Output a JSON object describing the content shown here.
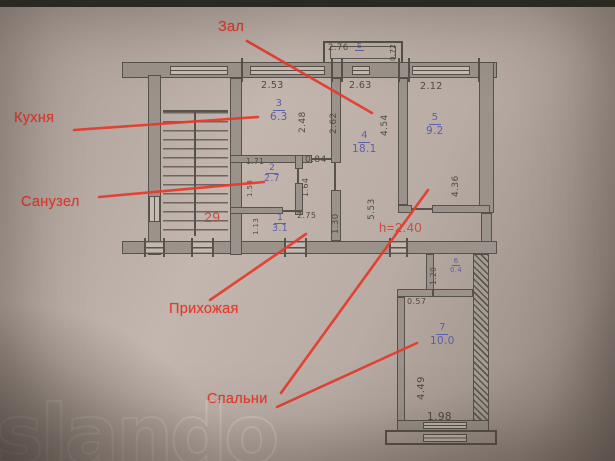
{
  "photo_type": "apartment floor plan photo",
  "watermark": "slando",
  "annotations": {
    "zal": "Зал",
    "kuhnya": "Кухня",
    "sanuzel": "Санузел",
    "prihozhaya": "Прихожая",
    "spalni": "Спальни",
    "apartment_number": "29",
    "ceiling_height": "h=2.40"
  },
  "colors": {
    "annotation_red": "#e63a2c",
    "room_number_blue": "#5c5fa9",
    "plan_line": "#57524b",
    "paper": "#b8aca4"
  },
  "rooms": {
    "r1": {
      "number": "1",
      "area": "3.1"
    },
    "r2": {
      "number": "2",
      "area": "2.7"
    },
    "r3": {
      "number": "3",
      "area": "6.3"
    },
    "r4": {
      "number": "4",
      "area": "18.1"
    },
    "r5": {
      "number": "5",
      "area": "9.2"
    },
    "r6": {
      "number": "6",
      "area": "0.4"
    },
    "r7": {
      "number": "7",
      "area": "10.0"
    }
  },
  "balcony": {
    "width": "2.76",
    "depth": "0.72",
    "mark": "Б"
  },
  "dims": {
    "r3_top": "2.53",
    "r3_right": "2.48",
    "r4_top": "2.63",
    "r4_left": "2.62",
    "r4_right": "4.54",
    "r4_len": "5.53",
    "r5_top": "2.12",
    "r5_right": "4.36",
    "r2_top": "1.71",
    "r2_left": "1.58",
    "r2_right": "1.64",
    "r2_off": "0.84",
    "r1_top": "2.75",
    "r1_left": "1.13",
    "hall_w": "1.30",
    "r6_left": "1.20",
    "r6_top": "0.57",
    "r7_left": "4.49",
    "r7_bottom": "1.98"
  }
}
